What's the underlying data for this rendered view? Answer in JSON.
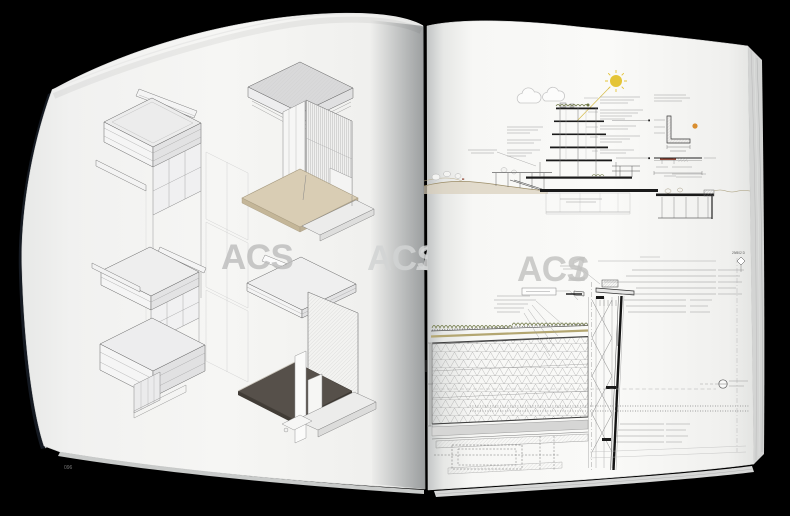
{
  "scene": {
    "description": "Photograph of an open architecture book spread on black background",
    "background_color": "#000000"
  },
  "book": {
    "left_page": {
      "page_number": "096",
      "watermark": {
        "letters": "ACS",
        "numeral": ""
      },
      "gutter_watermark": {
        "letters": "ACS",
        "numeral": "1"
      },
      "figures": {
        "tall_axonometric": "facade-bay-axonometric-three-levels",
        "axon_top_right": "corner-detail-louver-screen-timber-deck",
        "axon_bottom_right": "corner-detail-hatched-wall-dark-plate"
      }
    },
    "right_page": {
      "page_number": "097",
      "watermark": {
        "letters": "ACS",
        "numeral": "1"
      },
      "detail_marker": "29/802 D",
      "figures": {
        "top": "building-section-with-sun-clouds-terrain",
        "bottom": "roof-edge-curtain-wall-construction-detail"
      }
    }
  },
  "colors": {
    "paper": "#f4f4f2",
    "cover_edge": "#151a22",
    "sun": "#e4c437",
    "sun_ray": "#d8c053",
    "green_roof": "#6b7440",
    "terrain_line": "#9c8d68",
    "terrain_fill": "#d8cfba",
    "wood_plate": "#d9cdb4",
    "wood_plate_side": "#c4b698",
    "dark_plate": "#56504a",
    "dark_plate_side": "#413c36",
    "accent_orange": "#d98e2f",
    "accent_red": "#8a3b2a",
    "watermark_gray": "#c2c2c0",
    "ink": "#1a1a1a"
  }
}
